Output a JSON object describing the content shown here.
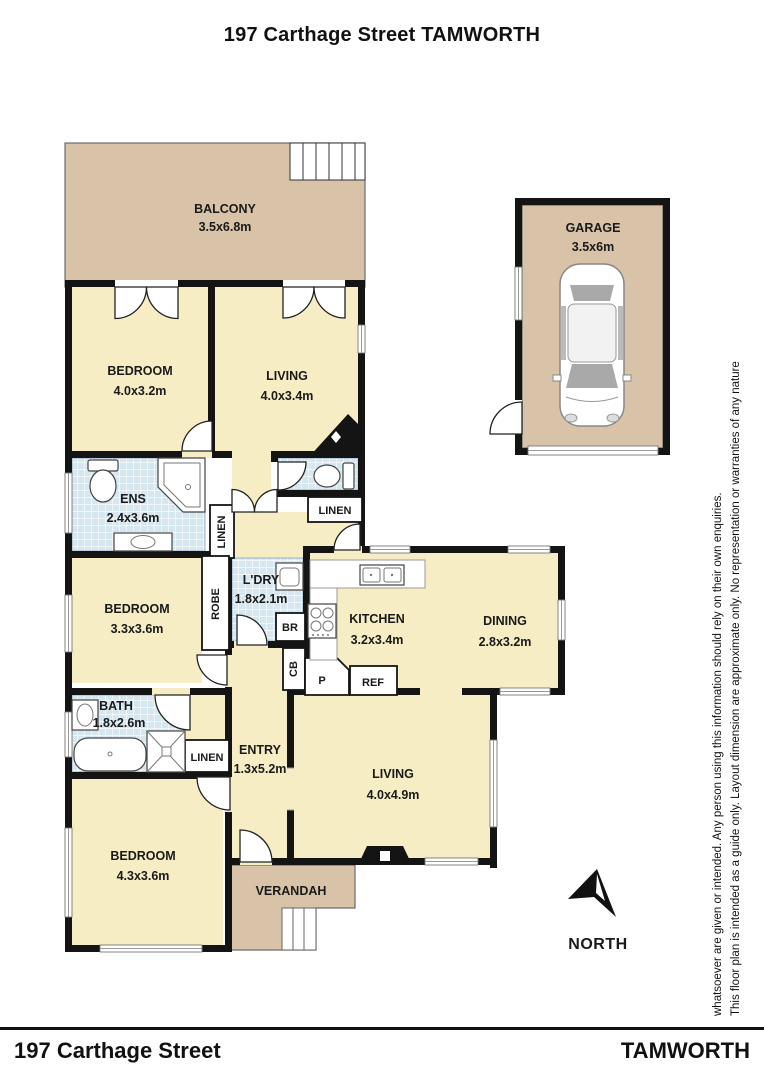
{
  "title": "197 Carthage Street TAMWORTH",
  "north_label": "NORTH",
  "rooms": {
    "balcony": {
      "name": "BALCONY",
      "dims": "3.5x6.8m"
    },
    "bedroom1": {
      "name": "BEDROOM",
      "dims": "4.0x3.2m"
    },
    "living1": {
      "name": "LIVING",
      "dims": "4.0x3.4m"
    },
    "ens": {
      "name": "ENS",
      "dims": "2.4x3.6m"
    },
    "bedroom2": {
      "name": "BEDROOM",
      "dims": "3.3x3.6m"
    },
    "laundry": {
      "name": "L'DRY",
      "dims": "1.8x2.1m"
    },
    "kitchen": {
      "name": "KITCHEN",
      "dims": "3.2x3.4m"
    },
    "dining": {
      "name": "DINING",
      "dims": "2.8x3.2m"
    },
    "bath": {
      "name": "BATH",
      "dims": "1.8x2.6m"
    },
    "entry": {
      "name": "ENTRY",
      "dims": "1.3x5.2m"
    },
    "living2": {
      "name": "LIVING",
      "dims": "4.0x4.9m"
    },
    "bedroom3": {
      "name": "BEDROOM",
      "dims": "4.3x3.6m"
    },
    "verandah": {
      "name": "VERANDAH"
    },
    "garage": {
      "name": "GARAGE",
      "dims": "3.5x6m"
    }
  },
  "closets": {
    "robe": "ROBE",
    "linen_ens": "LINEN",
    "linen_hall": "LINEN",
    "linen_bath": "LINEN",
    "broom": "BR",
    "cupboard": "CB",
    "pantry": "P",
    "fridge": "REF"
  },
  "disclaimer": {
    "line1": "This floor plan is intended as a guide only. Layout dimension are approximate only. No representation or warranties of any nature",
    "line2": "whatsoever are given or intended. Any person using this information should rely on their own enquiries."
  },
  "footer": {
    "left": "197 Carthage Street",
    "right": "TAMWORTH"
  },
  "colors": {
    "floor": "#f6edc4",
    "outdoor": "#d8c2a8",
    "tile": "#d6e7ef",
    "wall": "#141414"
  }
}
